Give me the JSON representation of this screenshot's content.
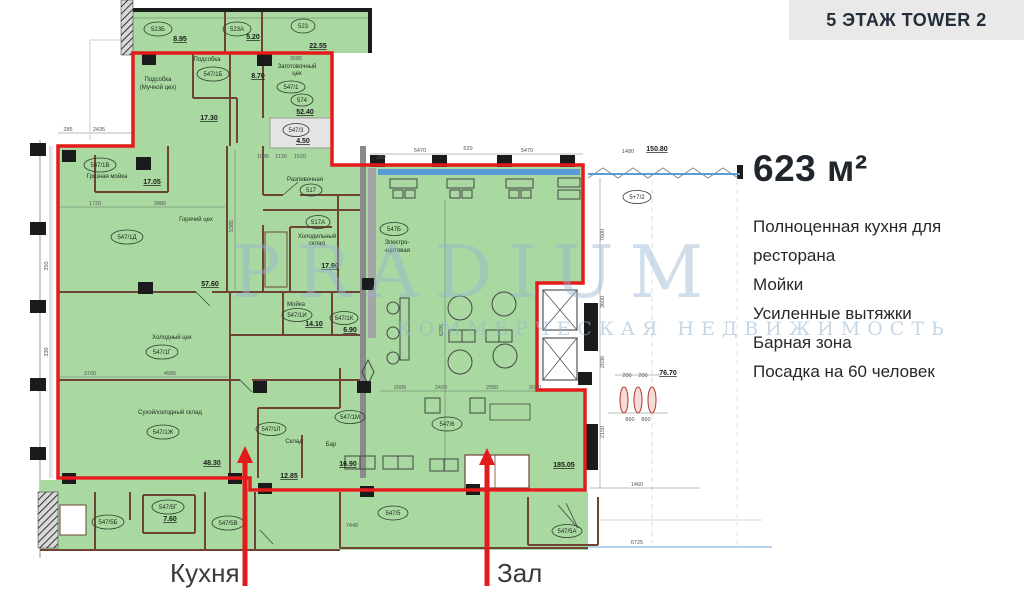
{
  "header": {
    "title": "5 ЭТАЖ TOWER 2"
  },
  "info": {
    "area": "623 м²",
    "features": [
      "Полноценная кухня для ресторана",
      "Мойки",
      "Усиленные вытяжки",
      "Барная зона",
      "Посадка на 60 человек"
    ]
  },
  "callouts": {
    "kitchen": "Кухня",
    "hall": "Зал"
  },
  "watermark": {
    "brand": "PRADIUM",
    "tagline": "КОММЕРЧЕСКАЯ НЕДВИЖИМОСТЬ"
  },
  "colors": {
    "accent_red": "#e31b1b",
    "plan_green": "#a9d9a1",
    "window_blue": "#5b9bd5"
  },
  "plan": {
    "ellipses": {
      "k523b": "523Б",
      "k523a": "523А",
      "k523": "523",
      "k547_1b": "547/1Б",
      "k547_1": "547/1",
      "k574": "574",
      "k547_3": "547/3",
      "k547_1v": "547/1В",
      "k547_1d": "547/1Д",
      "k517": "517",
      "k517a": "517А",
      "k547_1i": "547/1И",
      "k547_1k": "547/1К",
      "k547_1g": "547/1Г",
      "k547_1zh": "547/1Ж",
      "k547_1l": "547/1Л",
      "k547_1m": "547/1М",
      "k547b": "547Б",
      "k547_6": "547/6",
      "k5_7_2": "5+7/2",
      "k547_5b": "547/5Б",
      "k547_5g": "547/5Г",
      "k547_5v": "547/5В",
      "k547_5": "547/5",
      "k547_5a": "547/5А"
    },
    "names": {
      "podsobka": "Подсобка",
      "podsobka_much1": "Подсобка",
      "podsobka_much2": "(Мучной цех)",
      "zagotov1": "Заготовочный",
      "zagotov2": "цех",
      "gryaznaya": "Грязная мойка",
      "goryachiy": "Горячий цех",
      "kholodny": "Холодный цех",
      "razlivochnaya": "Разливочная",
      "khol_sklad1": "Холодильный",
      "khol_sklad2": "склад",
      "moyka": "Мойка",
      "sukhoy": "Сухой/холодный склад",
      "sklad": "Склад",
      "bar": "Бар",
      "elektro1": "Электро-",
      "elektro2": "-щитовая"
    },
    "areas": {
      "a523b": "8.95",
      "a523a": "5.20",
      "a523": "22.55",
      "a17_30": "17.30",
      "a8_70": "8.70",
      "a52_40": "52.40",
      "a4_50": "4.50",
      "a17_05": "17.05",
      "a57_60": "57.60",
      "a17_90": "17.90",
      "a14_10": "14.10",
      "a6_90": "6.90",
      "a48_30": "48.30",
      "a12_85": "12.85",
      "a16_90": "16.90",
      "a185_05": "185.05",
      "a7_60": "7.60",
      "a76_70": "76.70",
      "a150_80": "150.80"
    },
    "dims": {
      "d285": "285",
      "d2435": "2435",
      "d380": "380",
      "d5470a": "5470",
      "d520": "520",
      "d5470b": "5470",
      "d1480": "1480",
      "d1460": "1460",
      "d6725": "6725",
      "d7448": "7448",
      "d200a": "200",
      "d200b": "200",
      "d860a": "860",
      "d860b": "860",
      "d2005": "2005",
      "d2420": "2420",
      "d2050": "2050",
      "d2040": "2040",
      "d1720": "1720",
      "d3980": "3980",
      "d3700": "3700",
      "d4985": "4985",
      "d3685": "3685",
      "d1045": "1045",
      "d1130": "1130",
      "d1520": "1520",
      "d7600": "7600",
      "d3600": "3600",
      "d2036": "2036",
      "d2150": "2150",
      "d350": "350",
      "d330": "330",
      "d5385": "5385",
      "d6295": "6295"
    }
  }
}
